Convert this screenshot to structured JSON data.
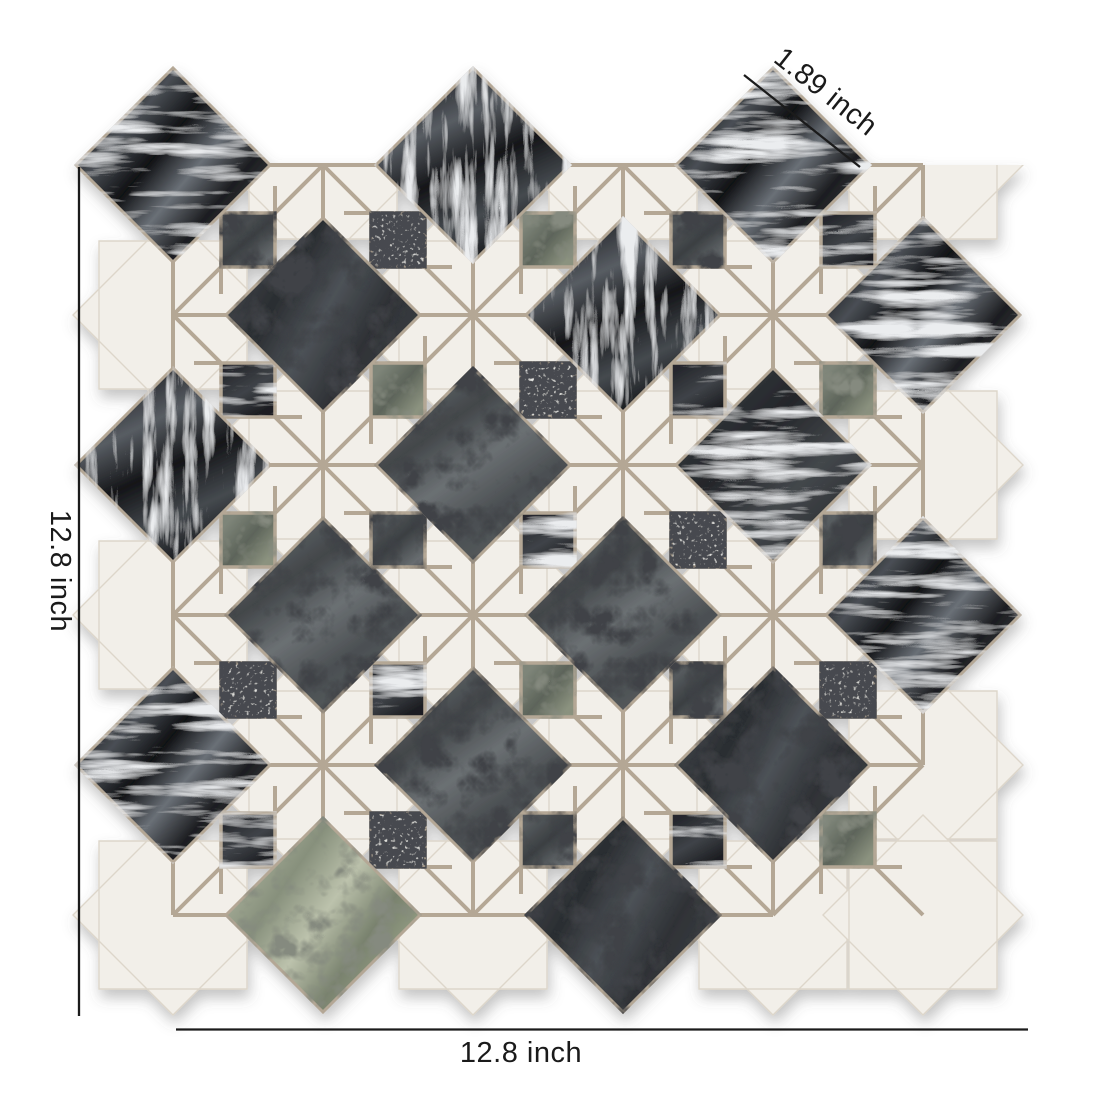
{
  "image_alt": "Black, gray and white marble mosaic tile sheet in a diamond-and-star pattern with printed dimensions",
  "annotations": {
    "diagonal": {
      "label": "1.89 inch"
    },
    "left": {
      "label": "12.8 inch"
    },
    "bottom": {
      "label": "12.8 inch"
    }
  },
  "palette": {
    "background": "#ffffff",
    "ink": "#1b1b1b",
    "white_marble": "#f2efe9",
    "white_marble_edge": "#ddd6ca",
    "grout": "#b4a795",
    "stone_black": "#1a1b1e",
    "stone_charcoal": "#34383c",
    "stone_gray": "#5b6063",
    "stone_green": "#98a18c",
    "vein_light": "#d4d8dd",
    "crack_dark": "#0d0e10",
    "speckle_base": "#e9e9e5"
  }
}
